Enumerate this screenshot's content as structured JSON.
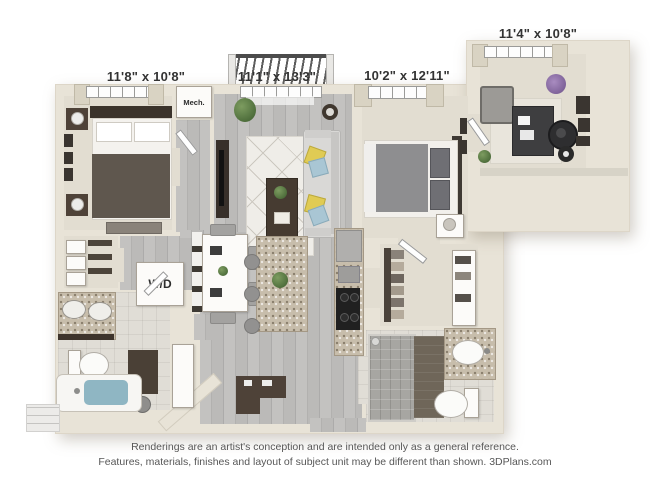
{
  "labels": {
    "bedroom_left": "11'8\" x 10'8\"",
    "living_room": "11'1\" x 13'3\"",
    "bedroom_right": "10'2\" x 12'11\"",
    "den": "11'4\" x 10'8\"",
    "mechanical_closet": "Mech.",
    "washer_dryer": "W/D"
  },
  "footer": {
    "line1": "Renderings are an artist's conception and are intended only as a general reference.",
    "line2": "Features, materials, finishes and layout of subject unit may be different than shown. 3DPlans.com"
  },
  "palette": {
    "wall": "#e8e3d7",
    "wood_floor": "#bcbbb9",
    "carpet": "#e2ddd1",
    "bathroom_tile": "#e0ddd6",
    "granite_counter": "#c7bdab",
    "dark_cabinetry": "#4e4238",
    "tub_water": "#8fb6c3",
    "pillow_yellow": "#e0cb54",
    "pillow_blue": "#a9c6d4",
    "label_text": "#333333",
    "footer_text": "#575757"
  }
}
